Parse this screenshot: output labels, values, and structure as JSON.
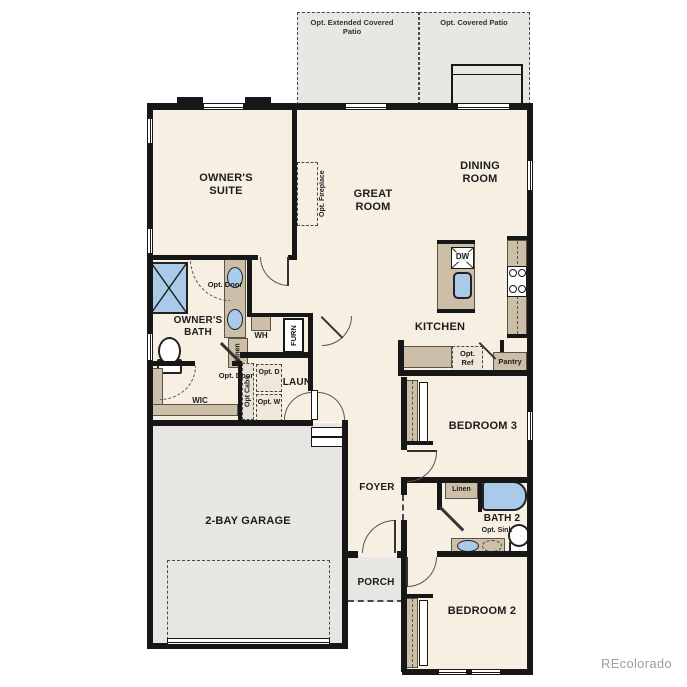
{
  "patios": {
    "extended_label": "Opt. Extended Covered Patio",
    "covered_label": "Opt. Covered Patio"
  },
  "rooms": {
    "owners_suite": "OWNER'S SUITE",
    "great_room": "GREAT ROOM",
    "dining_room": "DINING ROOM",
    "kitchen": "KITCHEN",
    "owners_bath": "OWNER'S BATH",
    "wic": "WIC",
    "laundry": "LAUN",
    "bedroom3": "BEDROOM 3",
    "bath2": "BATH 2",
    "bedroom2": "BEDROOM 2",
    "foyer": "FOYER",
    "porch": "PORCH",
    "garage": "2-BAY GARAGE"
  },
  "great_room_features": {
    "opt_fireplace": "Opt. Fireplace"
  },
  "kitchen_features": {
    "dw": "DW",
    "opt_ref": "Opt. Ref",
    "pantry": "Pantry"
  },
  "bath_features": {
    "opt_door_bath": "Opt. Door",
    "opt_door_wic": "Opt. Door",
    "linen": "Linen",
    "wh": "WH",
    "furn": "FURN"
  },
  "laundry_features": {
    "opt_cabs": "Opt Cabs",
    "opt_d": "Opt. D",
    "opt_w": "Opt. W"
  },
  "bath2_features": {
    "linen": "Linen",
    "opt_sink": "Opt. Sink"
  },
  "watermark": "REcolorado"
}
